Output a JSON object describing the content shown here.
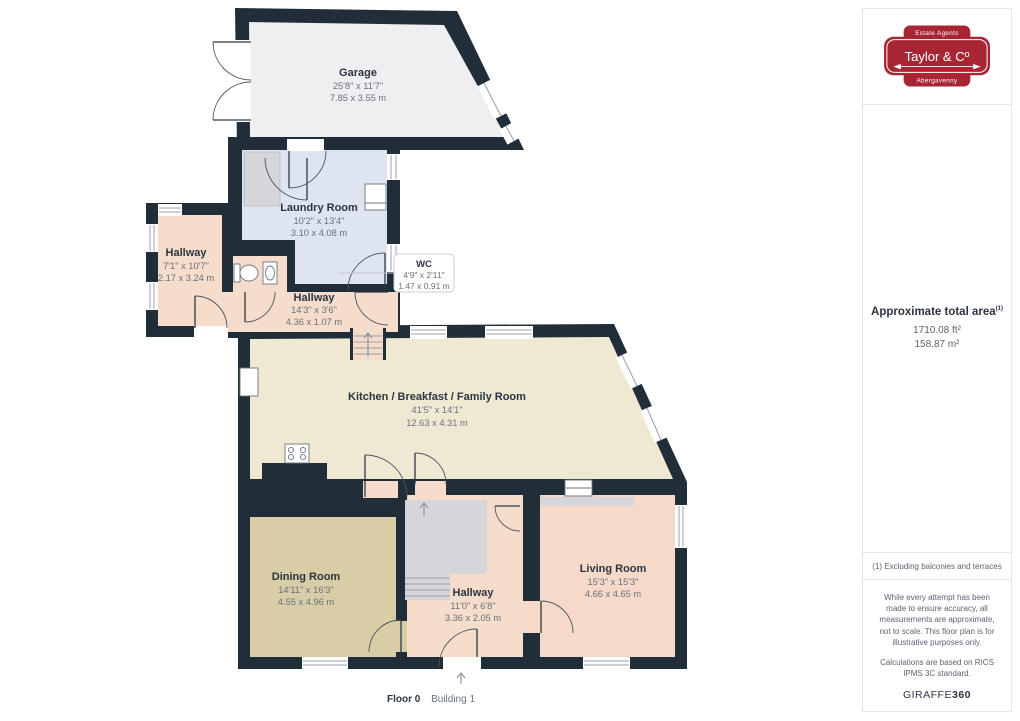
{
  "floorplan": {
    "footer": {
      "floor_label": "Floor 0",
      "building_label": "Building 1"
    },
    "rooms": {
      "garage": {
        "name": "Garage",
        "imperial": "25'8\" x 11'7\"",
        "metric": "7.85 x 3.55 m"
      },
      "laundry": {
        "name": "Laundry Room",
        "imperial": "10'2\" x 13'4\"",
        "metric": "3.10 x 4.08 m"
      },
      "hallway_left": {
        "name": "Hallway",
        "imperial": "7'1\" x 10'7\"",
        "metric": "2.17 x 3.24 m"
      },
      "wc": {
        "name": "WC",
        "imperial": "4'9\" x 2'11\"",
        "metric": "1.47 x 0.91 m"
      },
      "hallway_mid": {
        "name": "Hallway",
        "imperial": "14'3\" x 3'6\"",
        "metric": "4.36 x 1.07 m"
      },
      "kitchen": {
        "name": "Kitchen / Breakfast / Family Room",
        "imperial": "41'5\" x 14'1\"",
        "metric": "12.63 x 4.31 m"
      },
      "dining": {
        "name": "Dining Room",
        "imperial": "14'11\" x 16'3\"",
        "metric": "4.55 x 4.96 m"
      },
      "hallway_bottom": {
        "name": "Hallway",
        "imperial": "11'0\" x 6'8\"",
        "metric": "3.36 x 2.05 m"
      },
      "living": {
        "name": "Living Room",
        "imperial": "15'3\" x 15'3\"",
        "metric": "4.66 x 4.65 m"
      }
    }
  },
  "sidebar": {
    "logo": {
      "tagline_top": "Estate Agents",
      "name": "Taylor & Cº",
      "tagline_bottom": "Abergavenny"
    },
    "area": {
      "title": "Approximate total area",
      "footnote_marker": "(1)",
      "imperial": "1710.08 ft²",
      "metric": "158.87 m²"
    },
    "footnote": "(1) Excluding balconies and terraces",
    "disclaimer": {
      "line1": "While every attempt has been made to ensure accuracy, all measurements are approximate, not to scale. This floor plan is for illustrative purposes only.",
      "line2": "Calculations are based on RICS IPMS 3C standard."
    },
    "brand": {
      "name": "GIRAFFE",
      "suffix": "360"
    }
  },
  "colors": {
    "wall": "#222d3a",
    "garage_floor": "#efeff1",
    "laundry_floor": "#dfe5f0",
    "hallway_floor": "#f6dcca",
    "kitchen_floor": "#efe9d4",
    "dining_floor": "#d9cda7",
    "living_floor": "#f6d9c8",
    "stairs_gray": "#d5d6da",
    "brand_red": "#a82634"
  }
}
